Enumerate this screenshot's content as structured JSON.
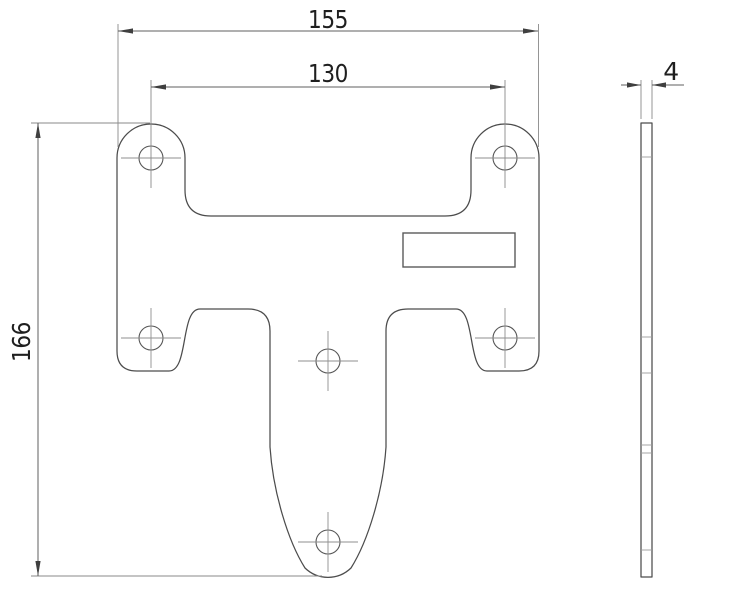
{
  "drawing": {
    "kind": "two-view mechanical part drawing",
    "views": {
      "front": {
        "label": "front-view-plate",
        "hole_count": 6,
        "has_rectangular_recess": true
      },
      "side": {
        "label": "side-profile-plate"
      }
    },
    "dimensions": {
      "overall_width": {
        "value": "155",
        "orientation": "horizontal",
        "applies_to": "plate overall width"
      },
      "hole_spacing": {
        "value": "130",
        "orientation": "horizontal",
        "applies_to": "upper hole centre distance"
      },
      "overall_height": {
        "value": "166",
        "orientation": "vertical",
        "applies_to": "plate overall height"
      },
      "thickness": {
        "value": "4",
        "orientation": "horizontal",
        "applies_to": "plate thickness (side view)"
      }
    },
    "colors": {
      "background": "#ffffff",
      "outline": "#4c4c4c",
      "dimension_line": "#5f5f5f",
      "extension_line": "#8a8a8a",
      "text": "#1f1f1f"
    }
  }
}
